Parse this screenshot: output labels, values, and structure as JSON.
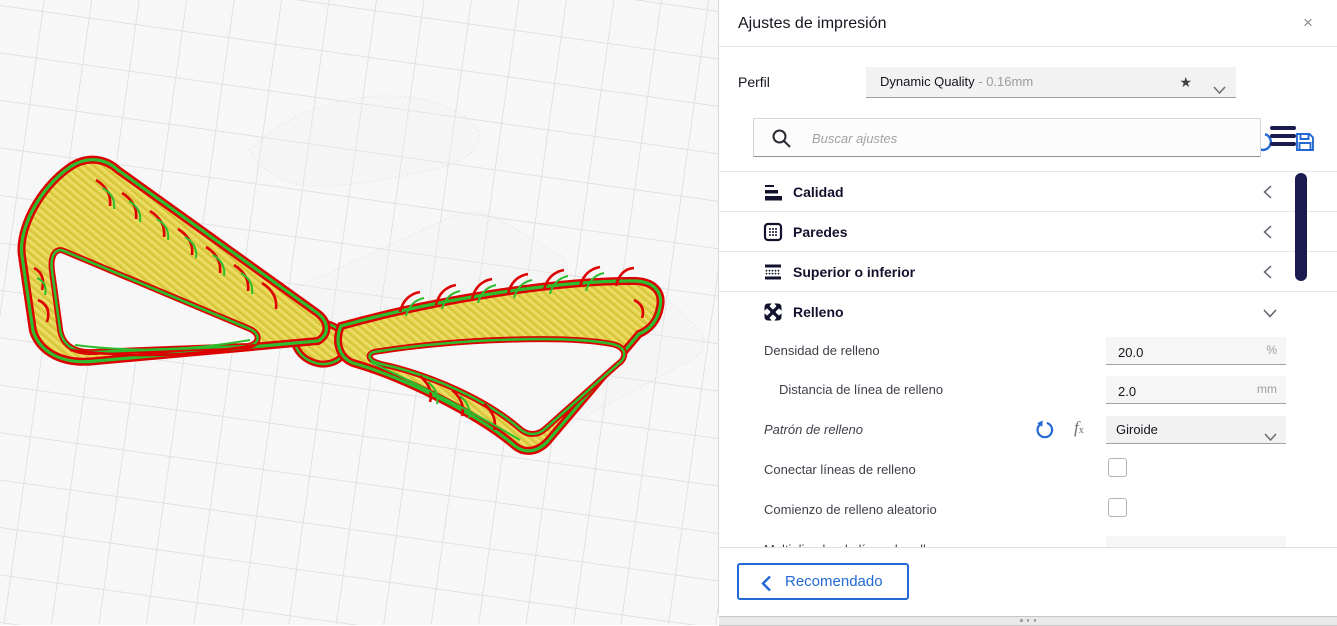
{
  "panel": {
    "title": "Ajustes de impresión",
    "close_label": "×",
    "profile": {
      "label": "Perfil",
      "name": "Dynamic Quality",
      "detail": " - 0.16mm",
      "star": "★"
    },
    "search": {
      "placeholder": "Buscar ajustes"
    },
    "categories": [
      {
        "label": "Calidad",
        "state": "collapsed"
      },
      {
        "label": "Paredes",
        "state": "collapsed"
      },
      {
        "label": "Superior o inferior",
        "state": "collapsed"
      },
      {
        "label": "Relleno",
        "state": "expanded"
      }
    ],
    "settings": {
      "infill_density": {
        "label": "Densidad de relleno",
        "value": "20.0",
        "unit": "%"
      },
      "infill_line_distance": {
        "label": "Distancia de línea de relleno",
        "value": "2.0",
        "unit": "mm"
      },
      "infill_pattern": {
        "label": "Patrón de relleno",
        "value": "Giroide",
        "modified": true
      },
      "connect_infill_lines": {
        "label": "Conectar líneas de relleno",
        "checked": false
      },
      "random_infill_start": {
        "label": "Comienzo de relleno aleatorio",
        "checked": false
      },
      "infill_line_multiplier": {
        "label": "Multiplicador de línea de relleno"
      }
    },
    "footer": {
      "button": "Recomendado"
    }
  },
  "viewport": {
    "content": "sliced glasses-frame model on build plate grid",
    "colors": {
      "outer_wall": "#dc0000",
      "inner_wall": "#2ebd2e",
      "infill": "#e6d44c"
    }
  },
  "colors": {
    "accent_blue": "#2368d4",
    "scrollbar_navy": "#1b1b52",
    "icon_navy": "#12122e"
  }
}
